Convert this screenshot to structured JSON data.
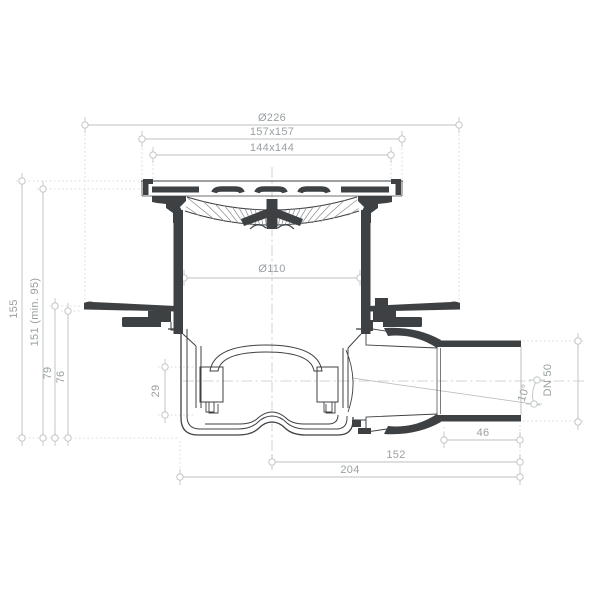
{
  "colors": {
    "ink": "#3e4144",
    "dim": "#bcc0c2",
    "ext": "#ced1d3",
    "cl": "#c6c9cb",
    "txt": "#9aa0a3",
    "bg": "#ffffff"
  },
  "dims": {
    "dia226": "Ø226",
    "sq157": "157x157",
    "sq144": "144x144",
    "dia110": "Ø110",
    "h155": "155",
    "h151": "151 (min. 95)",
    "h79": "79",
    "h76": "76",
    "h29": "29",
    "dn50": "DN 50",
    "angle10": "10°",
    "len46": "46",
    "len152": "152",
    "len204": "204"
  }
}
